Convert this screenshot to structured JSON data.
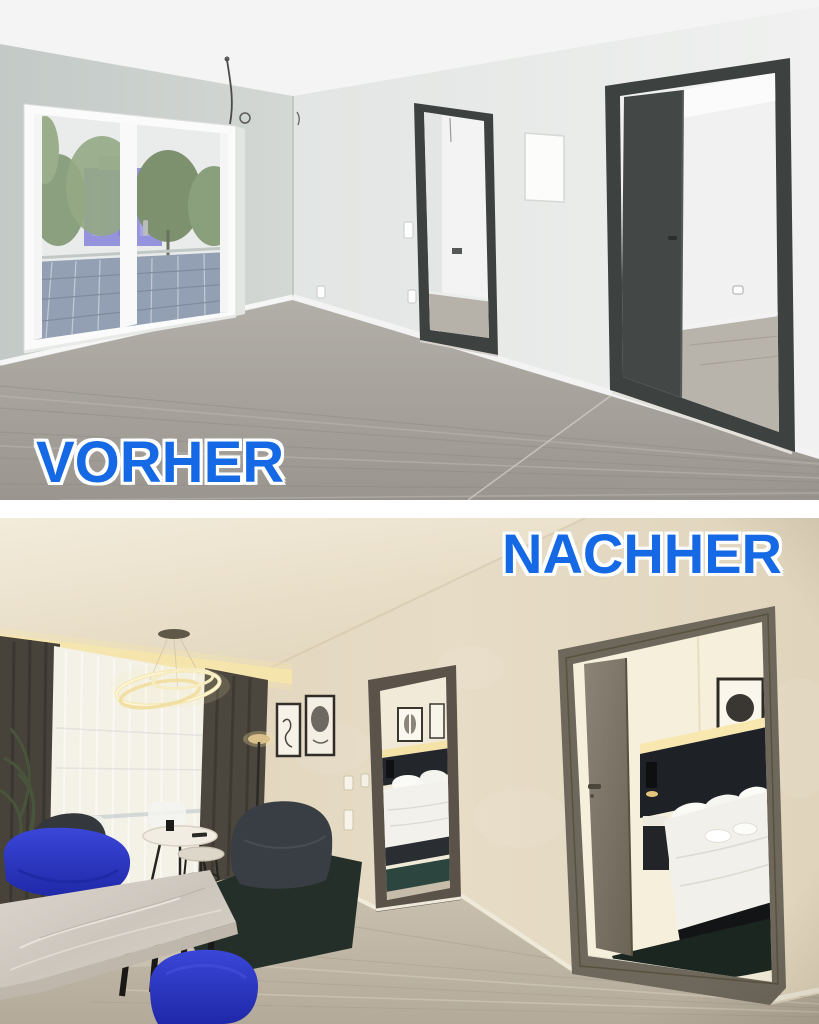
{
  "image": {
    "type": "before-after apartment renovation photo collage",
    "language": "German"
  },
  "labels": {
    "before": "VORHER",
    "after": "NACHHER"
  },
  "colors": {
    "label_blue": "#1569e5",
    "label_outline": "#ffffff",
    "divider": "#ffffff",
    "before_wall": "#cbd1ce",
    "before_back_wall": "#e8eae8",
    "before_floor": "#a5a19b",
    "door_frame_dark": "#3d4140",
    "after_wall": "#e4d8c1",
    "after_floor": "#c6bcab",
    "after_door_frame": "#6e675c",
    "chair_blue": "#2a34c0",
    "rug_green": "#232f28",
    "cove_light": "#f6e5ac"
  },
  "scenes": {
    "before": "Empty apartment living room: bare grey-green walls, large white balcony window with view of trees, a violet building and rooftop solar panels, grey laminate floor, a hanging ceiling cable and two dark anthracite doorways opening to empty rooms with a white access panel between them",
    "after": "Furnished apartment: living room with glowing ring chandelier, sheer and dark curtains with warm cove lighting, plant, wall art, floor lamp, dark curved sofa, royal blue velvet chairs, marble dining table, round coffee tables on a dark green rug, and two doorways showing hotel-style bedrooms with lit black headboards, white beds and dark green rugs"
  }
}
